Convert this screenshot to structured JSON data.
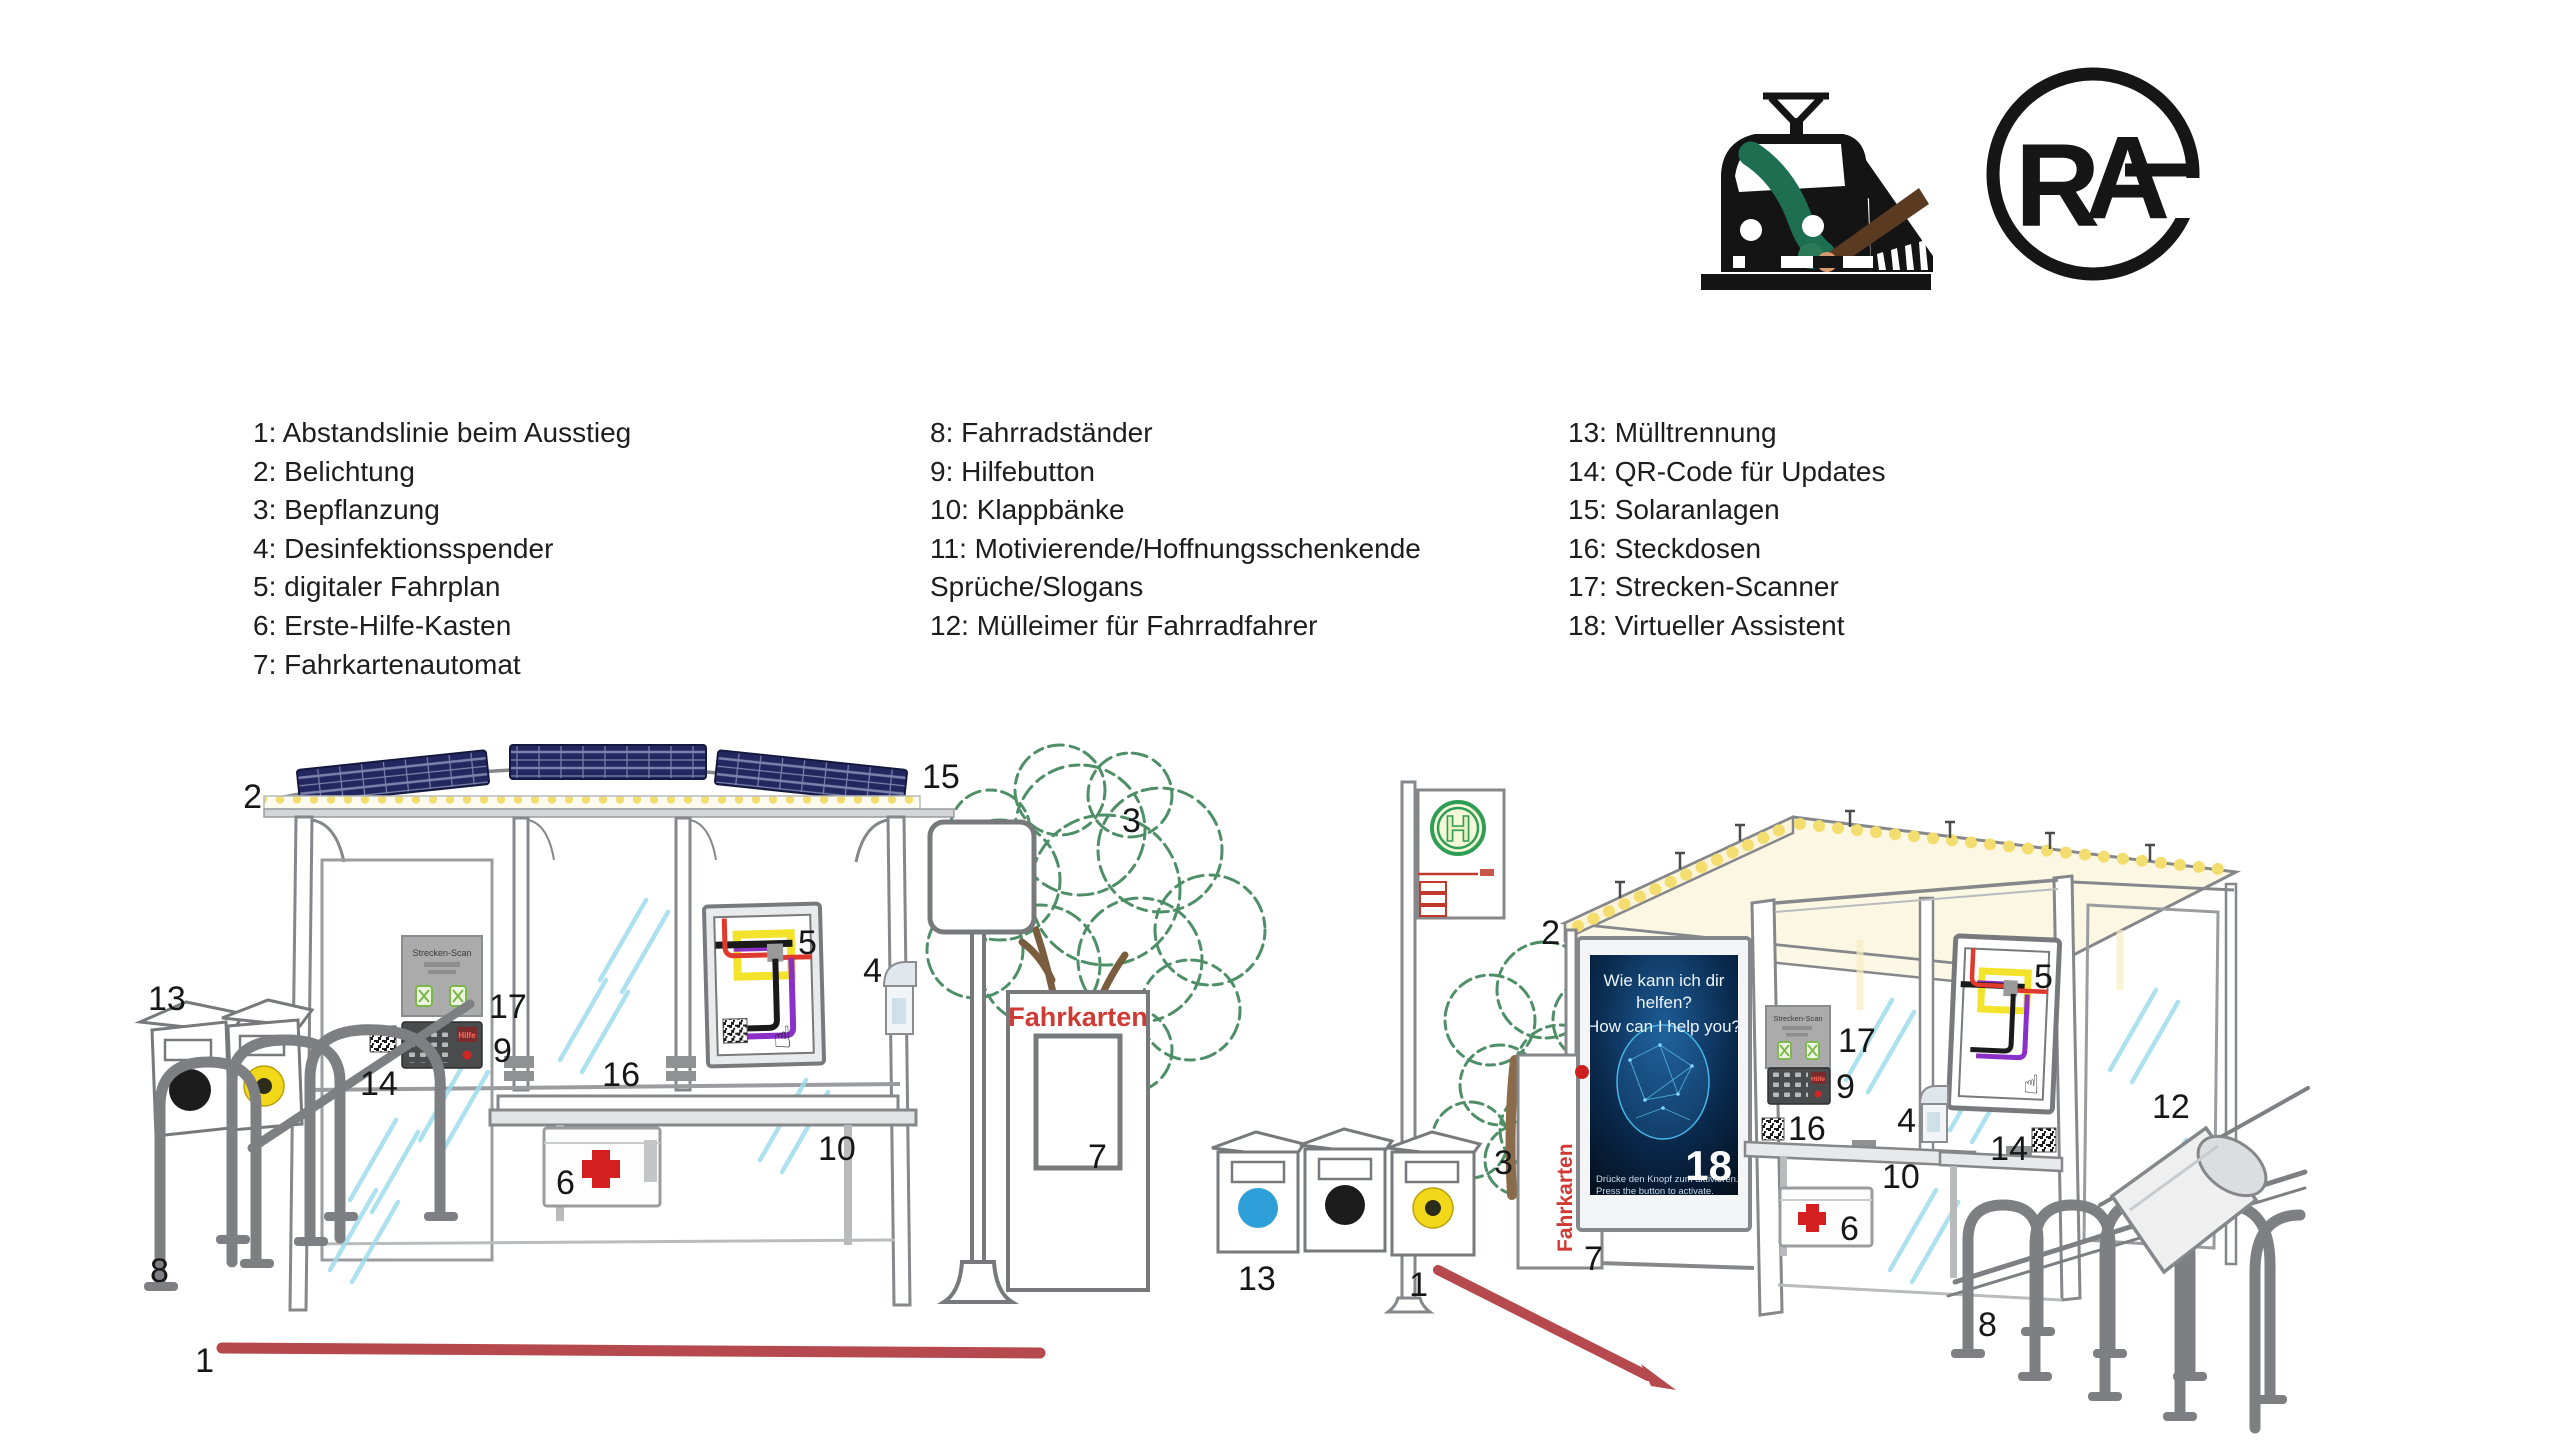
{
  "logos": {
    "train": {
      "name": "train-paintbrush-logo"
    },
    "rag": {
      "r": "R",
      "a": "A"
    }
  },
  "legend": {
    "col1": [
      "1: Abstandslinie beim Ausstieg",
      "2: Belichtung",
      "3: Bepflanzung",
      "4: Desinfektionsspender",
      "5: digitaler Fahrplan",
      "6: Erste-Hilfe-Kasten",
      "7: Fahrkartenautomat"
    ],
    "col2": [
      "8: Fahrradständer",
      "9: Hilfebutton",
      "10: Klappbänke",
      "11: Motivierende/Hoffnungsschenkende",
      "Sprüche/Slogans",
      "12: Mülleimer für Fahrradfahrer"
    ],
    "col3": [
      "13: Mülltrennung",
      "14: QR-Code für Updates",
      "15: Solaranlagen",
      "16: Steckdosen",
      "17: Strecken-Scanner",
      "18: Virtueller Assistent"
    ]
  },
  "scene": {
    "left": {
      "fahrkarten_label": "Fahrkarten",
      "scanner_title": "Strecken-Scan",
      "help_label": "Hilfe",
      "hand_icon": "☝"
    },
    "right": {
      "fahrkarten_label": "Fahrkarten",
      "scanner_title": "Strecken-Scan",
      "help_label": "Hilfe",
      "hand_icon": "☝",
      "h_sign": "H",
      "assistant": {
        "line1": "Wie kann ich dir",
        "line2": "helfen?",
        "line3": "How can I help you?",
        "footer1": "Drücke den Knopf zum aktivieren.",
        "footer2": "Press the button to activate.",
        "number": "18"
      }
    },
    "colors": {
      "distance_line": "#b5494d",
      "solar_panel": "#23275f",
      "led_yellow": "#f2dd6e",
      "tree_green": "#4e8f67",
      "glass_streak": "#9fdcec",
      "h_sign_green": "#2f9e55",
      "red_accent": "#d03a34",
      "bin_blue": "#2e9fd8",
      "bin_yellow": "#f2d818",
      "bin_black": "#1c1c1c"
    }
  },
  "callouts": {
    "left": [
      "2",
      "15",
      "13",
      "8",
      "17",
      "9",
      "14",
      "16",
      "5",
      "10",
      "6",
      "4",
      "3",
      "7",
      "1"
    ],
    "right": [
      "2",
      "13",
      "1",
      "3",
      "7",
      "17",
      "9",
      "16",
      "4",
      "10",
      "6",
      "5",
      "14",
      "12",
      "8"
    ]
  }
}
